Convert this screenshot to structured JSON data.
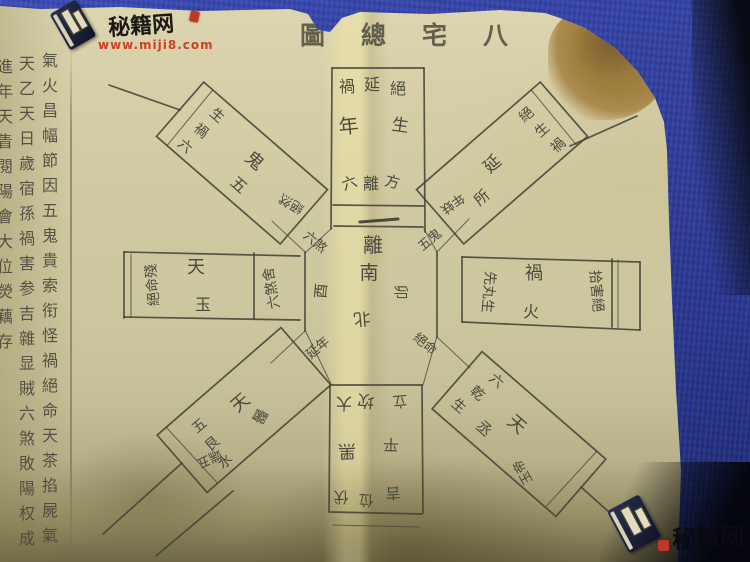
{
  "watermarks": {
    "top_left": {
      "site": "秘籍网",
      "url": "www.miji8.com"
    },
    "bottom_right": {
      "site": "秘籍网"
    }
  },
  "title": {
    "text_rtl": "八宅總圖",
    "c1": "圖",
    "c2": "總",
    "c3": "宅",
    "c4": "八"
  },
  "margin_text": {
    "col_left": "進年天眚閱陽會大位熒藕存",
    "col_mid": "天乙天日歲宿孫禍害参吉雜显賊六煞敗陽权成存",
    "col_right": "氣火昌幅節因五鬼貴索衔怪禍絕命天茶掐屍氣"
  },
  "diagram": {
    "center": {
      "trigram": "離",
      "south": "南",
      "west": "酉",
      "east": "卯",
      "north": "北"
    },
    "top_arm": {
      "o1": "禍",
      "o2": "延",
      "o3": "絕",
      "m1": "年",
      "m2": "生",
      "i1": "六",
      "i2": "離",
      "i3": "方"
    },
    "bottom_arm": {
      "i1": "大",
      "i2": "坎",
      "i3": "立",
      "m1": "黑",
      "m2": "平",
      "o1": "伏",
      "o2": "位",
      "o3": "吉"
    },
    "left_arm": {
      "outer": "絕命殘",
      "t1": "天",
      "t2": "玉",
      "inner": "六煞舍"
    },
    "right_arm": {
      "inner": "先丸生",
      "t1": "禍",
      "t2": "火",
      "outer": "拾害絕"
    },
    "box_ul": {
      "s1": "生",
      "s2": "禍",
      "s3": "六",
      "b1": "鬼",
      "b2": "五",
      "cluster": "絕然"
    },
    "box_ur": {
      "s1": "絕",
      "s2": "生",
      "s3": "禍",
      "b1": "延",
      "b2": "所",
      "cluster": "年蚨"
    },
    "box_ll": {
      "s1": "五",
      "s2": "艮",
      "s3": "水",
      "b1": "天",
      "b2": "醫",
      "cluster": "端五"
    },
    "box_lr": {
      "s1": "六",
      "s2": "乾",
      "s3": "生",
      "b1": "天",
      "b2": "丞",
      "cluster": "玉帝"
    },
    "corner_ul": "六煞",
    "corner_ur": "五鬼",
    "corner_ll": "延年",
    "corner_lr": "絕命"
  },
  "colors": {
    "cloth": "#2f3fa4",
    "paper": "#d2cba4",
    "ink": "#3e4034",
    "stain": "#9c7d42",
    "watermark_red": "#cc3318"
  }
}
